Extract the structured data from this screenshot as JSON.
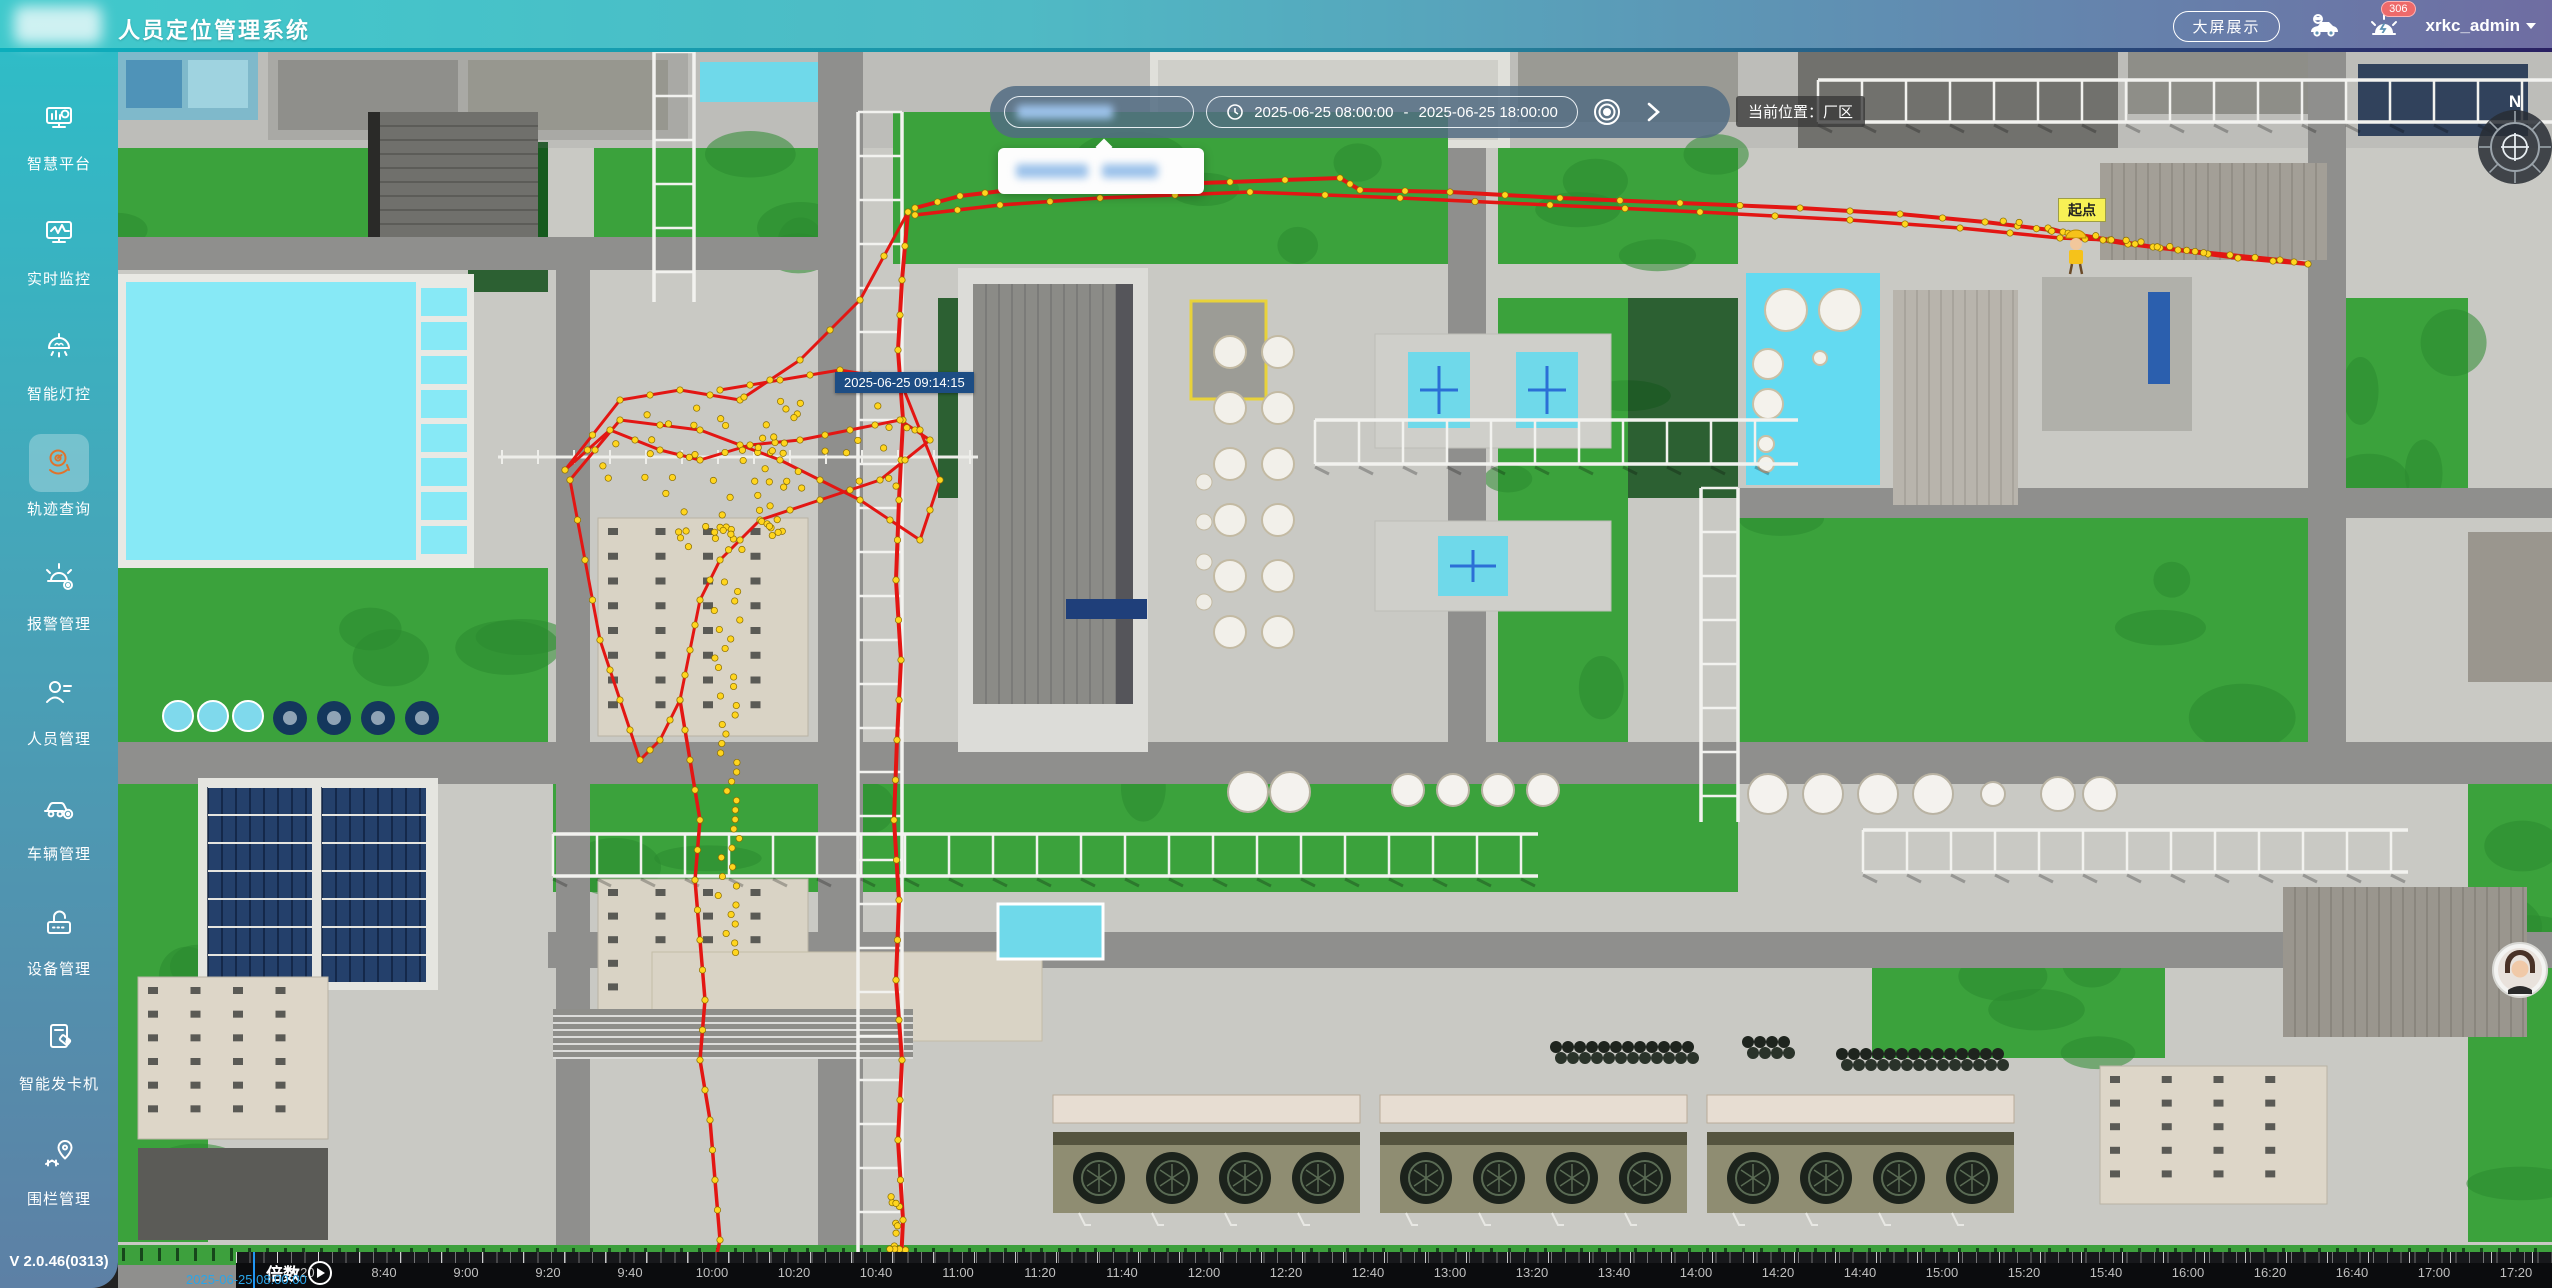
{
  "header": {
    "title": "人员定位管理系统",
    "big_screen_button": "大屏展示",
    "alarm_badge": "306",
    "username": "xrkc_admin"
  },
  "sidebar": {
    "items": [
      {
        "id": "smart-platform",
        "label": "智慧平台"
      },
      {
        "id": "realtime-monitor",
        "label": "实时监控"
      },
      {
        "id": "smart-light",
        "label": "智能灯控"
      },
      {
        "id": "track-query",
        "label": "轨迹查询",
        "active": true
      },
      {
        "id": "alarm-mgmt",
        "label": "报警管理"
      },
      {
        "id": "personnel-mgmt",
        "label": "人员管理"
      },
      {
        "id": "vehicle-mgmt",
        "label": "车辆管理"
      },
      {
        "id": "device-mgmt",
        "label": "设备管理"
      },
      {
        "id": "card-dispenser",
        "label": "智能发卡机"
      },
      {
        "id": "fence-mgmt",
        "label": "围栏管理"
      }
    ],
    "version": "V 2.0.46(0313)"
  },
  "toolbar": {
    "date_start": "2025-06-25 08:00:00",
    "date_separator": "-",
    "date_end": "2025-06-25 18:00:00",
    "current_location": "当前位置：厂区"
  },
  "map": {
    "tooltip": "2025-06-25 09:14:15",
    "start_label": "起点",
    "compass_label": "N"
  },
  "timeline": {
    "speed_label": "倍数",
    "current_time": "2025-06-25 08:00:00",
    "ticks": [
      "8:20",
      "8:40",
      "9:00",
      "9:20",
      "9:40",
      "10:00",
      "10:20",
      "10:40",
      "11:00",
      "11:20",
      "11:40",
      "12:00",
      "12:20",
      "12:40",
      "13:00",
      "13:20",
      "13:40",
      "14:00",
      "14:20",
      "14:40",
      "15:00",
      "15:20",
      "15:40",
      "16:00",
      "16:20",
      "16:40",
      "17:00",
      "17:20",
      "17:40"
    ]
  },
  "colors": {
    "header_teal": "#3fc9cc",
    "header_purple": "#6f6da2",
    "sidebar_bottom": "#5d80a5",
    "track_red": "#e31613",
    "track_dot_yellow": "#ffd51e",
    "pool_cyan": "#87e9f6",
    "playhead_blue": "#2196f3"
  }
}
